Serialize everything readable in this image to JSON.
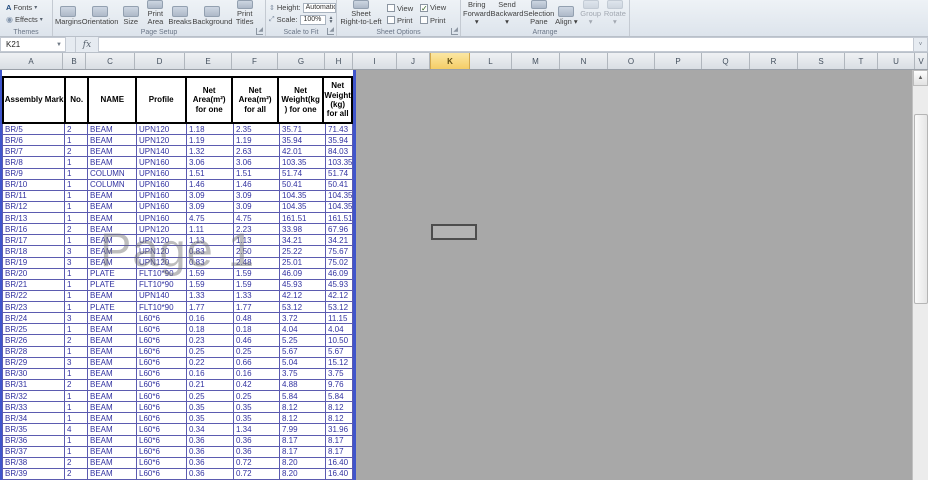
{
  "ribbon": {
    "themes": {
      "label": "Themes",
      "fonts": "Fonts",
      "effects": "Effects"
    },
    "page_setup": {
      "label": "Page Setup",
      "buttons": [
        "Margins",
        "Orientation",
        "Size",
        "Print\nArea",
        "Breaks",
        "Background",
        "Print\nTitles"
      ]
    },
    "scale_to_fit": {
      "label": "Scale to Fit",
      "height_label": "Height:",
      "height_value": "Automatic",
      "scale_label": "Scale:",
      "scale_value": "100%"
    },
    "sheet_options": {
      "label": "Sheet Options",
      "rtl_button": "Sheet\nRight-to-Left",
      "checkbox_columns": [
        {
          "view_label": "View",
          "view_checked": false,
          "print_label": "Print",
          "print_checked": false
        },
        {
          "view_label": "View",
          "view_checked": true,
          "print_label": "Print",
          "print_checked": false
        }
      ]
    },
    "arrange": {
      "label": "Arrange",
      "buttons": [
        {
          "text": "Bring\nForward",
          "caret": true,
          "disabled": false
        },
        {
          "text": "Send\nBackward",
          "caret": true,
          "disabled": false
        },
        {
          "text": "Selection\nPane",
          "caret": false,
          "disabled": false
        },
        {
          "text": "Align",
          "caret": true,
          "disabled": false
        },
        {
          "text": "Group",
          "caret": true,
          "disabled": true
        },
        {
          "text": "Rotate",
          "caret": true,
          "disabled": true
        }
      ]
    }
  },
  "formula_bar": {
    "name_box": "K21",
    "fx_label": "fx",
    "formula_value": ""
  },
  "column_headers": {
    "selected": "K",
    "columns": [
      {
        "letter": "A",
        "w": 63
      },
      {
        "letter": "B",
        "w": 23
      },
      {
        "letter": "C",
        "w": 49
      },
      {
        "letter": "D",
        "w": 50
      },
      {
        "letter": "E",
        "w": 47
      },
      {
        "letter": "F",
        "w": 46
      },
      {
        "letter": "G",
        "w": 47
      },
      {
        "letter": "H",
        "w": 28
      },
      {
        "letter": "I",
        "w": 44
      },
      {
        "letter": "J",
        "w": 33
      },
      {
        "letter": "K",
        "w": 40
      },
      {
        "letter": "L",
        "w": 42
      },
      {
        "letter": "M",
        "w": 48
      },
      {
        "letter": "N",
        "w": 48
      },
      {
        "letter": "O",
        "w": 47
      },
      {
        "letter": "P",
        "w": 47
      },
      {
        "letter": "Q",
        "w": 48
      },
      {
        "letter": "R",
        "w": 48
      },
      {
        "letter": "S",
        "w": 47
      },
      {
        "letter": "T",
        "w": 33
      },
      {
        "letter": "U",
        "w": 37
      },
      {
        "letter": "V",
        "w": 13
      }
    ]
  },
  "sheet": {
    "watermark": "Page 1",
    "selected_cell": "K21",
    "table": {
      "col_widths": [
        63,
        23,
        49,
        50,
        47,
        46,
        46,
        27
      ],
      "headers": [
        "Assembly Mark",
        "No.",
        "NAME",
        "Profile",
        "Net\nArea(m²)\nfor one",
        "Net\nArea(m²)\nfor all",
        "Net\nWeight(kg\n) for one",
        "Net\nWeight\n(kg)\nfor all"
      ],
      "rows": [
        [
          "BR/5",
          "2",
          "BEAM",
          "UPN120",
          "1.18",
          "2.35",
          "35.71",
          "71.43"
        ],
        [
          "BR/6",
          "1",
          "BEAM",
          "UPN120",
          "1.19",
          "1.19",
          "35.94",
          "35.94"
        ],
        [
          "BR/7",
          "2",
          "BEAM",
          "UPN140",
          "1.32",
          "2.63",
          "42.01",
          "84.03"
        ],
        [
          "BR/8",
          "1",
          "BEAM",
          "UPN160",
          "3.06",
          "3.06",
          "103.35",
          "103.35"
        ],
        [
          "BR/9",
          "1",
          "COLUMN",
          "UPN160",
          "1.51",
          "1.51",
          "51.74",
          "51.74"
        ],
        [
          "BR/10",
          "1",
          "COLUMN",
          "UPN160",
          "1.46",
          "1.46",
          "50.41",
          "50.41"
        ],
        [
          "BR/11",
          "1",
          "BEAM",
          "UPN160",
          "3.09",
          "3.09",
          "104.35",
          "104.35"
        ],
        [
          "BR/12",
          "1",
          "BEAM",
          "UPN160",
          "3.09",
          "3.09",
          "104.35",
          "104.35"
        ],
        [
          "BR/13",
          "1",
          "BEAM",
          "UPN160",
          "4.75",
          "4.75",
          "161.51",
          "161.51"
        ],
        [
          "BR/16",
          "2",
          "BEAM",
          "UPN120",
          "1.11",
          "2.23",
          "33.98",
          "67.96"
        ],
        [
          "BR/17",
          "1",
          "BEAM",
          "UPN120",
          "1.13",
          "1.13",
          "34.21",
          "34.21"
        ],
        [
          "BR/18",
          "3",
          "BEAM",
          "UPN120",
          "0.83",
          "2.50",
          "25.22",
          "75.67"
        ],
        [
          "BR/19",
          "3",
          "BEAM",
          "UPN120",
          "0.83",
          "2.48",
          "25.01",
          "75.02"
        ],
        [
          "BR/20",
          "1",
          "PLATE",
          "FLT10*90",
          "1.59",
          "1.59",
          "46.09",
          "46.09"
        ],
        [
          "BR/21",
          "1",
          "PLATE",
          "FLT10*90",
          "1.59",
          "1.59",
          "45.93",
          "45.93"
        ],
        [
          "BR/22",
          "1",
          "BEAM",
          "UPN140",
          "1.33",
          "1.33",
          "42.12",
          "42.12"
        ],
        [
          "BR/23",
          "1",
          "PLATE",
          "FLT10*90",
          "1.77",
          "1.77",
          "53.12",
          "53.12"
        ],
        [
          "BR/24",
          "3",
          "BEAM",
          "L60*6",
          "0.16",
          "0.48",
          "3.72",
          "11.15"
        ],
        [
          "BR/25",
          "1",
          "BEAM",
          "L60*6",
          "0.18",
          "0.18",
          "4.04",
          "4.04"
        ],
        [
          "BR/26",
          "2",
          "BEAM",
          "L60*6",
          "0.23",
          "0.46",
          "5.25",
          "10.50"
        ],
        [
          "BR/28",
          "1",
          "BEAM",
          "L60*6",
          "0.25",
          "0.25",
          "5.67",
          "5.67"
        ],
        [
          "BR/29",
          "3",
          "BEAM",
          "L60*6",
          "0.22",
          "0.66",
          "5.04",
          "15.12"
        ],
        [
          "BR/30",
          "1",
          "BEAM",
          "L60*6",
          "0.16",
          "0.16",
          "3.75",
          "3.75"
        ],
        [
          "BR/31",
          "2",
          "BEAM",
          "L60*6",
          "0.21",
          "0.42",
          "4.88",
          "9.76"
        ],
        [
          "BR/32",
          "1",
          "BEAM",
          "L60*6",
          "0.25",
          "0.25",
          "5.84",
          "5.84"
        ],
        [
          "BR/33",
          "1",
          "BEAM",
          "L60*6",
          "0.35",
          "0.35",
          "8.12",
          "8.12"
        ],
        [
          "BR/34",
          "1",
          "BEAM",
          "L60*6",
          "0.35",
          "0.35",
          "8.12",
          "8.12"
        ],
        [
          "BR/35",
          "4",
          "BEAM",
          "L60*6",
          "0.34",
          "1.34",
          "7.99",
          "31.96"
        ],
        [
          "BR/36",
          "1",
          "BEAM",
          "L60*6",
          "0.36",
          "0.36",
          "8.17",
          "8.17"
        ],
        [
          "BR/37",
          "1",
          "BEAM",
          "L60*6",
          "0.36",
          "0.36",
          "8.17",
          "8.17"
        ],
        [
          "BR/38",
          "2",
          "BEAM",
          "L60*6",
          "0.36",
          "0.72",
          "8.20",
          "16.40"
        ],
        [
          "BR/39",
          "2",
          "BEAM",
          "L60*6",
          "0.36",
          "0.72",
          "8.20",
          "16.40"
        ]
      ]
    }
  },
  "colors": {
    "off_page_gray": "#a8a8a8",
    "page_break_blue": "#3f55cc",
    "cell_text_navy": "#3232a0",
    "selected_column_gold": "#f4cd66"
  }
}
